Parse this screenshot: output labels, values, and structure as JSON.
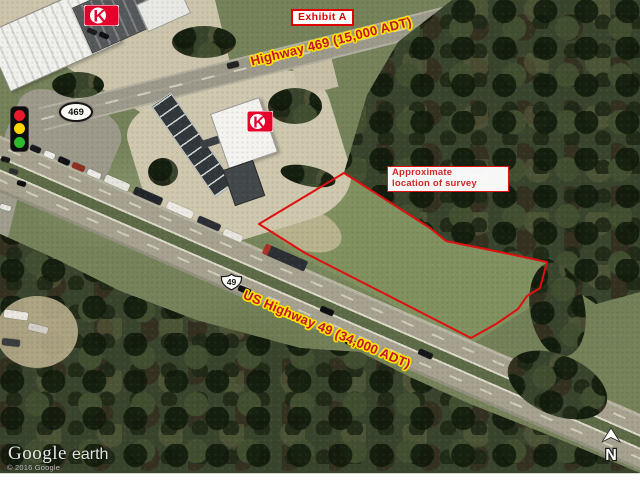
{
  "map": {
    "exhibit_label": "Exhibit A",
    "highway_469_label": "Highway 469 (15,000 ADT)",
    "us_highway_49_label": "US Highway 49 (34,000 ADT)",
    "survey_note": {
      "line1": "Approximate",
      "line2": "location of survey"
    },
    "route_shield_469": "469",
    "route_shield_49": "49",
    "north_arrow_label": "N",
    "circle_k_letter": "K",
    "survey_polygon_points": "344,173 430,228 446,241 490,250 547,262 540,288 527,296 518,309 496,324 471,338 305,253 259,224"
  },
  "watermark": {
    "brand": "Google",
    "product": "earth",
    "copyright": "© 2016 Google"
  },
  "colors": {
    "annotation_red": "#de1010",
    "label_red": "#c41230",
    "halo_yellow": "#ffe400",
    "note_red": "#d02828",
    "exhibit_red": "#e00000",
    "circle_k_red": "#e4002b",
    "signal_red": "#e8192c",
    "signal_yellow": "#ffd500",
    "signal_green": "#2db928"
  }
}
